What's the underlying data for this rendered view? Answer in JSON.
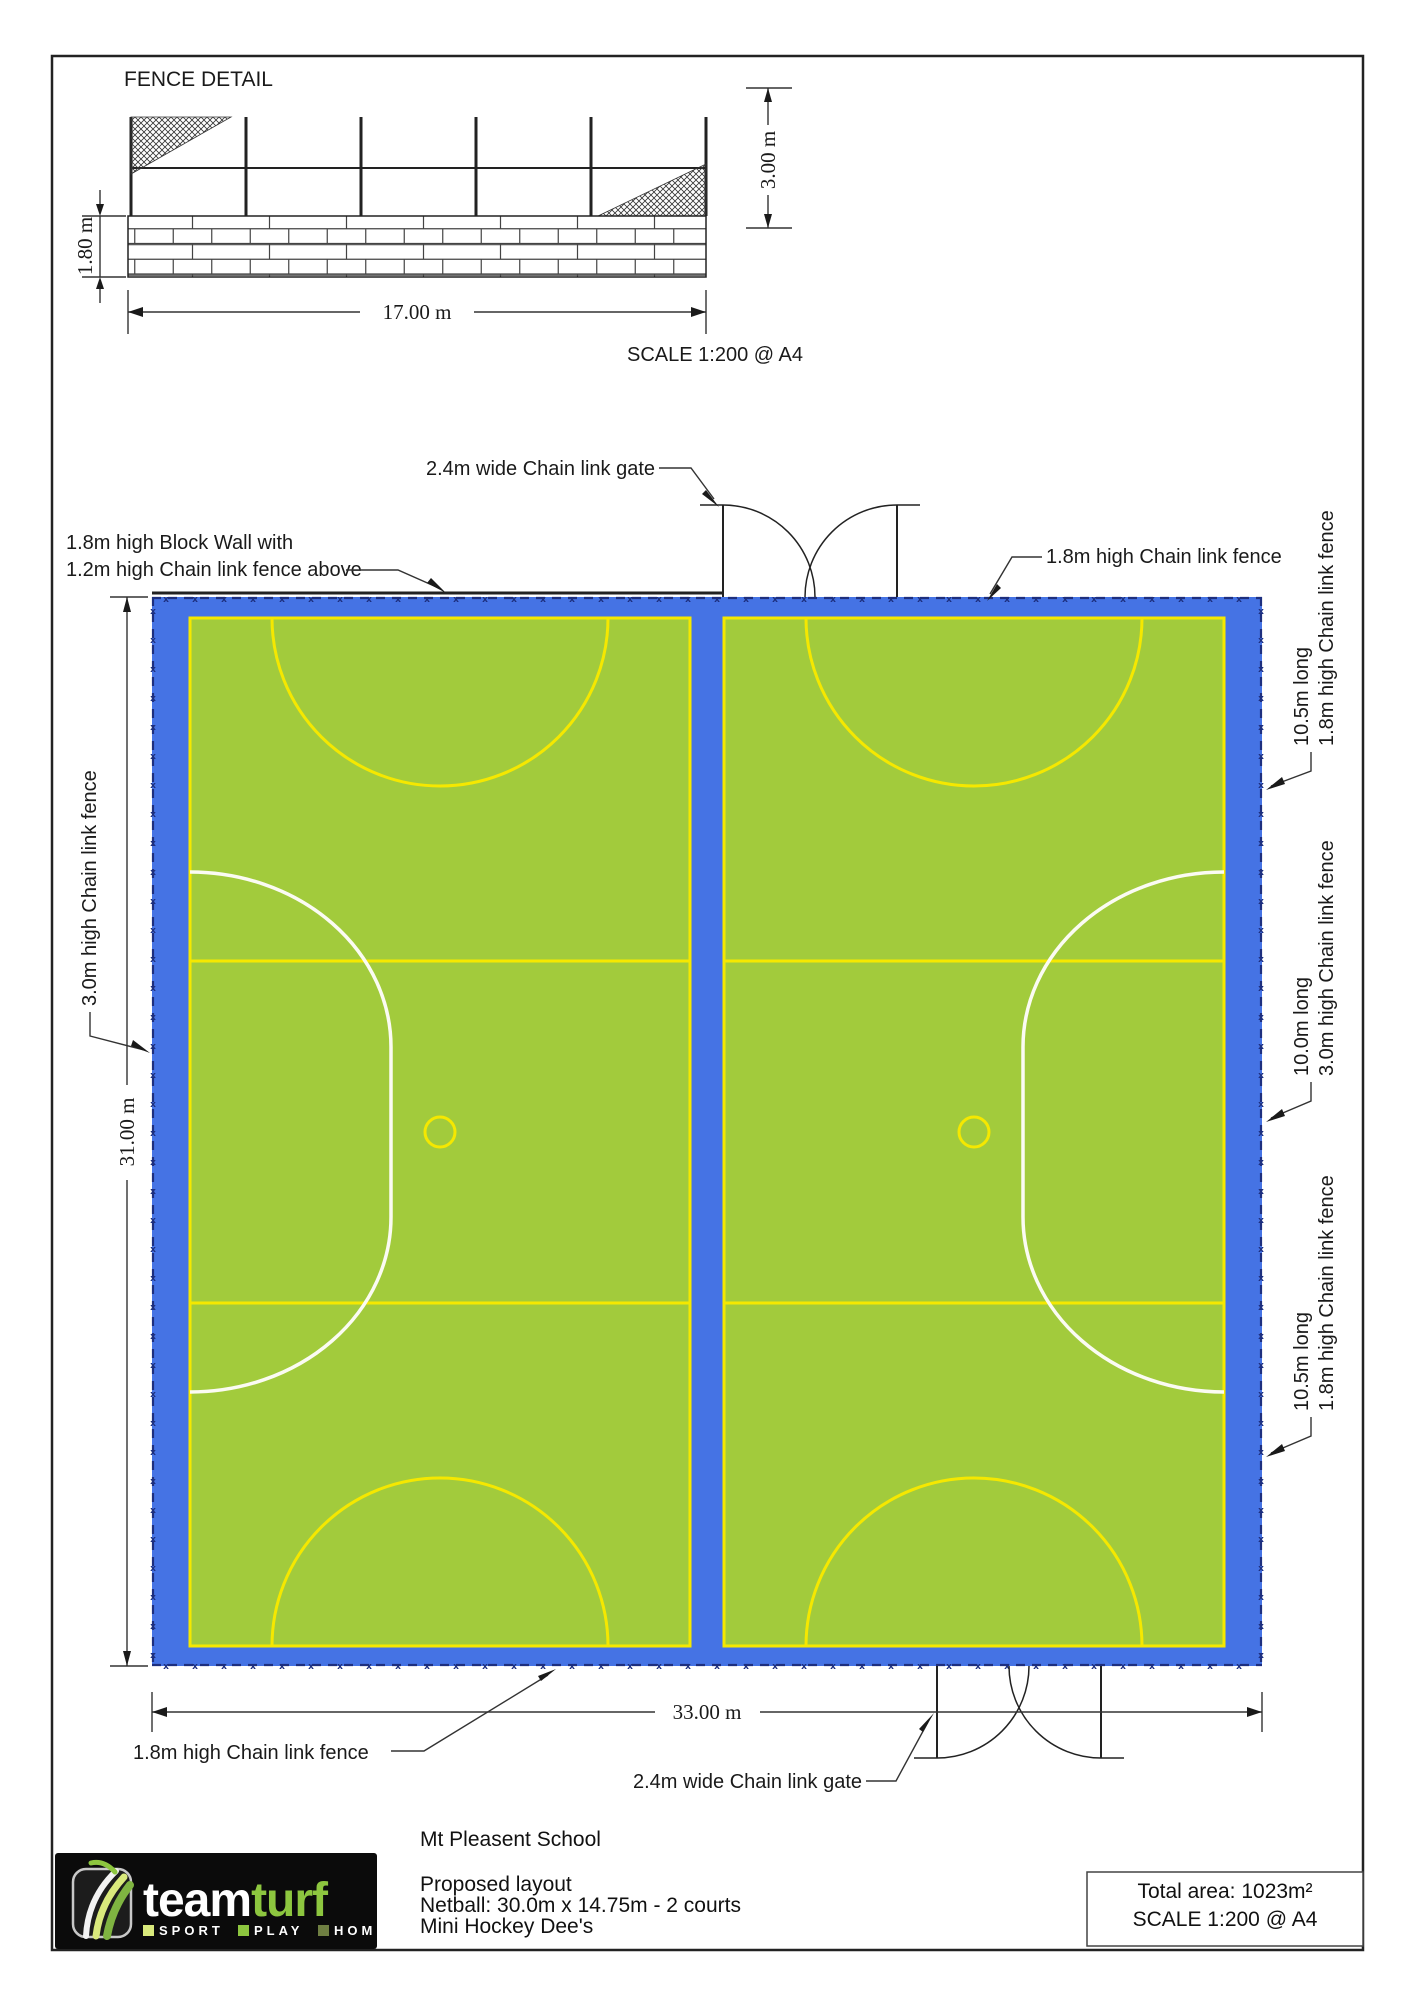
{
  "fence_detail": {
    "title": "FENCE DETAIL",
    "wall_height": "1.80 m",
    "fence_height": "3.00 m",
    "length": "17.00 m",
    "scale_note": "SCALE 1:200 @ A4"
  },
  "plan": {
    "gate_top_label": "2.4m wide Chain link gate",
    "gate_bottom_label": "2.4m wide Chain link gate",
    "block_wall_label_line1": "1.8m high Block Wall with",
    "block_wall_label_line2": "1.2m high Chain link fence above",
    "fence_top_right_label": "1.8m high Chain link fence",
    "fence_bottom_left_label": "1.8m high Chain link fence",
    "fence_left_label": "3.0m high Chain link fence",
    "dim_height": "31.00 m",
    "dim_width": "33.00 m",
    "side_labels": [
      {
        "line1": "10.5m long",
        "line2": "1.8m high Chain link fence"
      },
      {
        "line1": "10.0m long",
        "line2": "3.0m high Chain link fence"
      },
      {
        "line1": "10.5m long",
        "line2": "1.8m high Chain link fence"
      }
    ]
  },
  "title_block": {
    "logo": {
      "word1": "team",
      "word2": "turf",
      "tagline": [
        "SPORT",
        "PLAY",
        "HOME"
      ]
    },
    "client": "Mt Pleasent School",
    "project_lines": [
      "Proposed layout",
      "Netball: 30.0m x 14.75m - 2 courts",
      "Mini Hockey Dee's"
    ],
    "total_area": "Total area: 1023m²",
    "scale": "SCALE 1:200 @ A4"
  },
  "colors": {
    "surround_blue": "#4573E4",
    "court_green": "#A2CB3C",
    "line_yellow": "#F5E800",
    "line_white": "#FBFBF3",
    "fence_navy": "#1D2F7F",
    "logo_green": "#8DC63F"
  }
}
